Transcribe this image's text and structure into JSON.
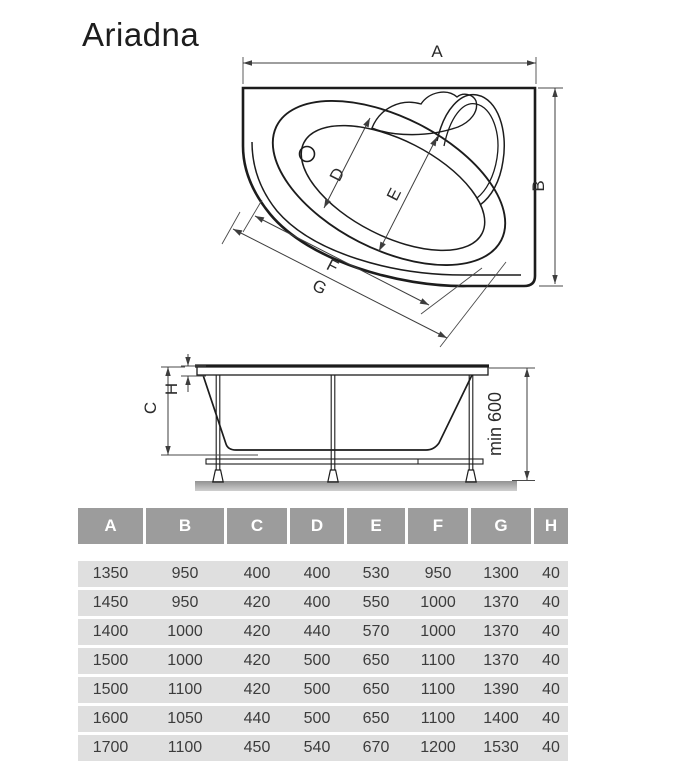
{
  "title": "Ariadna",
  "colors": {
    "header_bg": "#9c9c9c",
    "header_text": "#ffffff",
    "row_bg": "#dfdfdf",
    "row_text": "#3c3c3c",
    "drawing_line": "#1c1c1c",
    "dimension_line": "#3d3d3d",
    "ground": "#a8a8a8"
  },
  "top_view": {
    "dim_a": "A",
    "dim_b": "B",
    "dim_d": "D",
    "dim_e": "E",
    "dim_f": "F",
    "dim_g": "G"
  },
  "side_view": {
    "dim_c": "C",
    "dim_h": "H",
    "min_height": "min 600"
  },
  "table": {
    "headers": [
      "A",
      "B",
      "C",
      "D",
      "E",
      "F",
      "G",
      "H"
    ],
    "rows": [
      [
        "1350",
        "950",
        "400",
        "400",
        "530",
        "950",
        "1300",
        "40"
      ],
      [
        "1450",
        "950",
        "420",
        "400",
        "550",
        "1000",
        "1370",
        "40"
      ],
      [
        "1400",
        "1000",
        "420",
        "440",
        "570",
        "1000",
        "1370",
        "40"
      ],
      [
        "1500",
        "1000",
        "420",
        "500",
        "650",
        "1100",
        "1370",
        "40"
      ],
      [
        "1500",
        "1100",
        "420",
        "500",
        "650",
        "1100",
        "1390",
        "40"
      ],
      [
        "1600",
        "1050",
        "440",
        "500",
        "650",
        "1100",
        "1400",
        "40"
      ],
      [
        "1700",
        "1100",
        "450",
        "540",
        "670",
        "1200",
        "1530",
        "40"
      ]
    ]
  }
}
